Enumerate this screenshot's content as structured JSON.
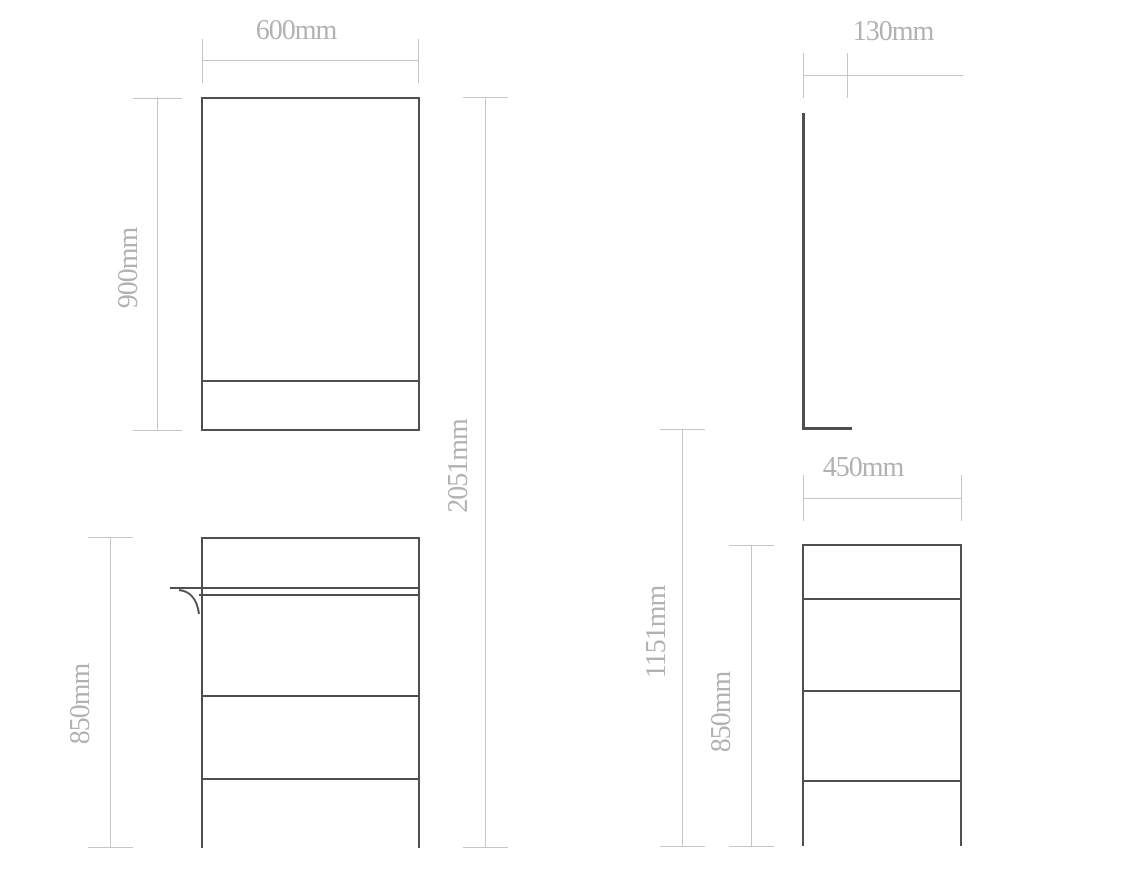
{
  "drawing": {
    "type": "furniture-dimension-technical-drawing",
    "colors": {
      "background": "#ffffff",
      "furniture_outline": "#4f4f4f",
      "dimension_line": "#c6c6c6",
      "dimension_text": "#b2b2b2"
    },
    "front_view": {
      "mirror_width_label": "600mm",
      "mirror_height_label": "900mm",
      "total_height_label": "2051mm",
      "cabinet_height_label": "850mm"
    },
    "side_view": {
      "mirror_depth_label": "130mm",
      "cabinet_depth_label": "450mm",
      "cabinet_height_label": "850mm",
      "floor_to_mirror_height_label": "1151mm"
    }
  }
}
